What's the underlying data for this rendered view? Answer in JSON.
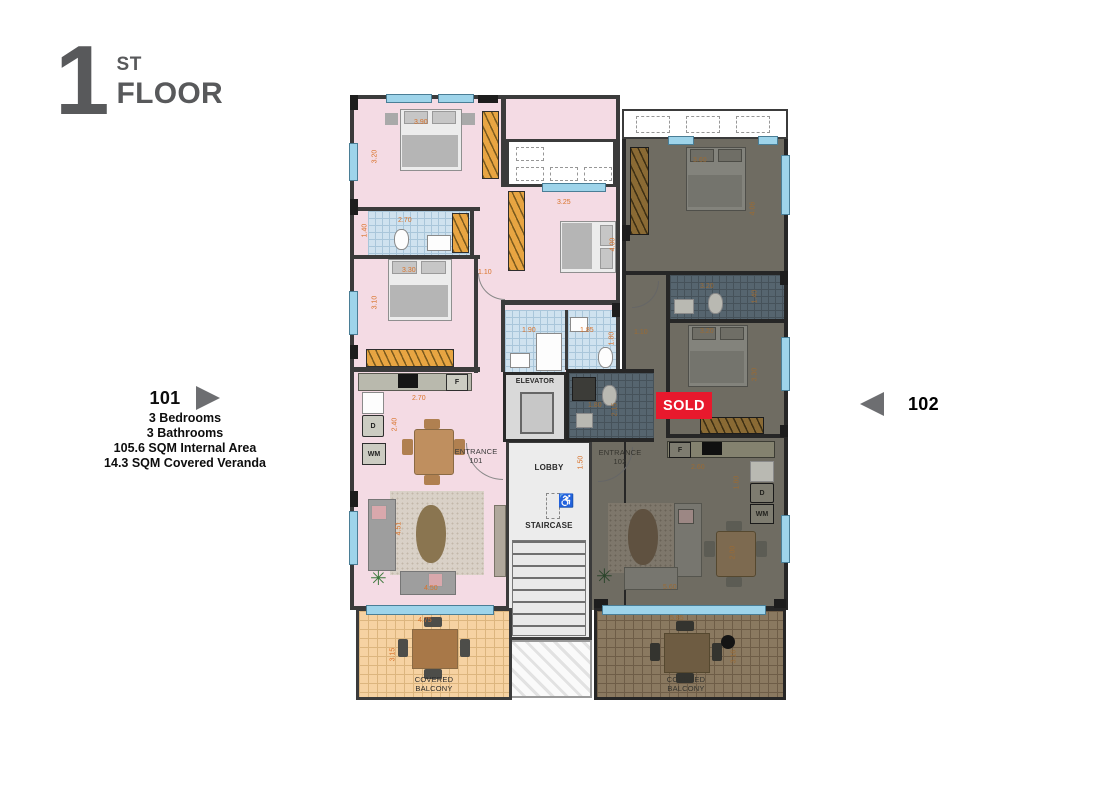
{
  "header": {
    "floor_number": "1",
    "floor_suffix": "ST",
    "floor_word": "FLOOR"
  },
  "apartments": {
    "a101": {
      "number": "101",
      "details": [
        "3 Bedrooms",
        "3 Bathrooms",
        "105.6 SQM Internal Area",
        "14.3 SQM Covered Veranda"
      ]
    },
    "a102": {
      "number": "102",
      "status": "SOLD"
    }
  },
  "plan": {
    "labels": {
      "elevator": "ELEVATOR",
      "lobby": "LOBBY",
      "staircase": "STAIRCASE",
      "entrance": "ENTRANCE",
      "unit1": "101",
      "unit2": "102",
      "balcony_l1": "COVERED",
      "balcony_l2": "BALCONY",
      "fridge": "F",
      "dishwasher": "D",
      "washer": "WM",
      "accessible_icon": "♿"
    },
    "dims_101": [
      "3.90",
      "3.20",
      "2.70",
      "1.40",
      "3.30",
      "3.10",
      "1.10",
      "3.25",
      "4.00",
      "1.90",
      "1.85",
      "1.80",
      "2.70",
      "2.40",
      "1.50",
      "4.51",
      "4.50",
      "4.75",
      "3.15"
    ],
    "dims_102": [
      "1.10",
      "3.60",
      "4.06",
      "3.20",
      "1.40",
      "3.20",
      "3.30",
      "1.80",
      "2.15",
      "2.60",
      "1.80",
      "2.00",
      "5.60",
      "5.85",
      "3.16"
    ]
  },
  "colors": {
    "accent_red": "#E8192D",
    "dim_orange": "#D9732B",
    "title_gray": "#58595B",
    "apt101_floor": "#F4DBE4",
    "bath_tile": "#CFE2EF",
    "balcony_tile": "#F6D2A2",
    "sold_overlay_floor": "#6F6C62",
    "wall": "#3B3B3B",
    "window_blue": "#9ED4EA",
    "wardrobe_orange": "#E8A542"
  }
}
